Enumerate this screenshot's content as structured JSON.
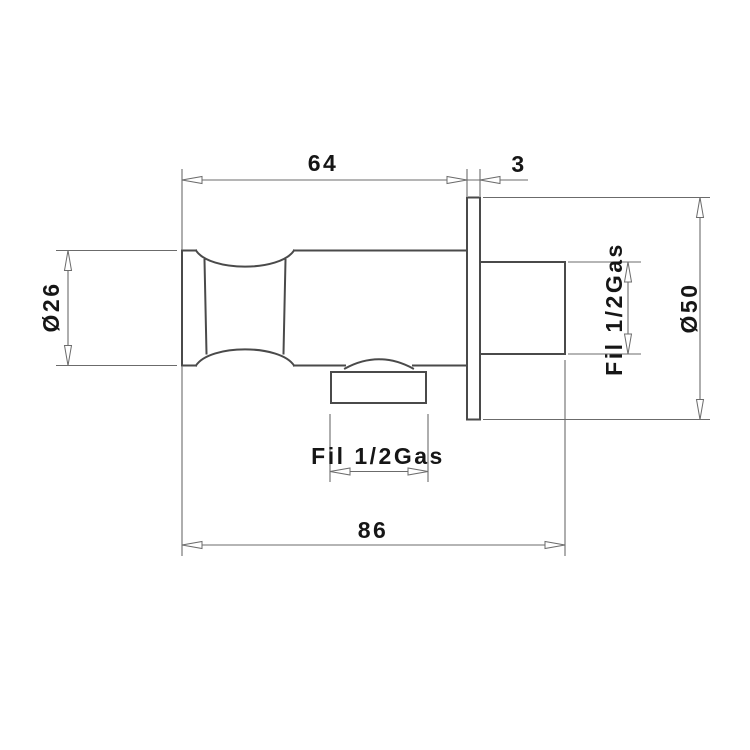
{
  "drawing": {
    "type": "technical-dimension-drawing",
    "subject": "wall-mounted water outlet fitting, side view",
    "background": "#ffffff",
    "colors": {
      "object_line": "#4a4a4a",
      "dimension_line": "#6b6b6b",
      "text": "#161616",
      "arrow_fill": "#ffffff"
    },
    "dimensions": {
      "body_length": "64",
      "plate_thickness": "3",
      "overall_length": "86",
      "handle_diameter": "Ø26",
      "flange_diameter": "Ø50",
      "wall_thread_label": "Fil 1/2Gas",
      "outlet_thread_label": "Fil 1/2Gas"
    }
  }
}
